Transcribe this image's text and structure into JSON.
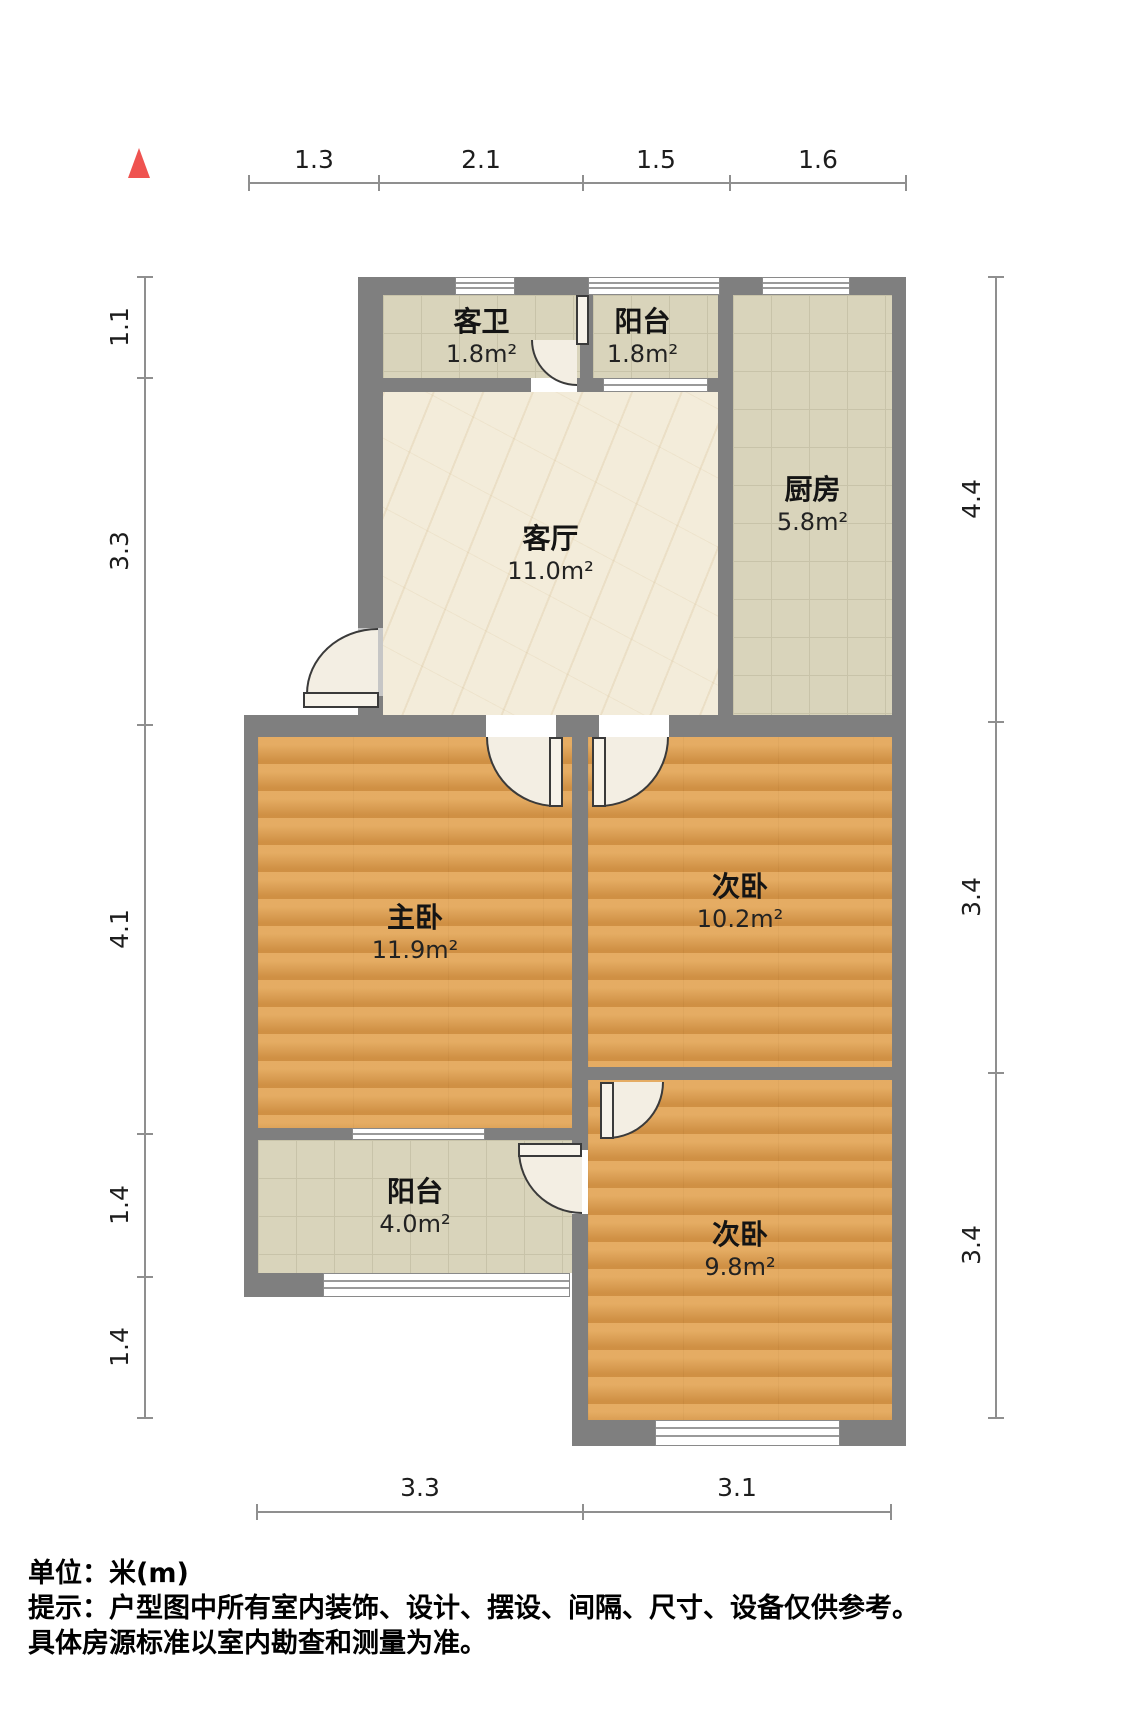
{
  "rooms": [
    {
      "name": "客卫",
      "area": "1.8m²"
    },
    {
      "name": "阳台",
      "area": "1.8m²"
    },
    {
      "name": "厨房",
      "area": "5.8m²"
    },
    {
      "name": "客厅",
      "area": "11.0m²"
    },
    {
      "name": "主卧",
      "area": "11.9m²"
    },
    {
      "name": "次卧",
      "area": "10.2m²"
    },
    {
      "name": "阳台",
      "area": "4.0m²"
    },
    {
      "name": "次卧",
      "area": "9.8m²"
    }
  ],
  "dimensions": {
    "top": [
      "1.3",
      "2.1",
      "1.5",
      "1.6"
    ],
    "left": [
      "1.1",
      "3.3",
      "4.1",
      "1.4",
      "1.4"
    ],
    "right": [
      "4.4",
      "3.4",
      "3.4"
    ],
    "bottom": [
      "3.3",
      "3.1"
    ]
  },
  "footer": {
    "line1": "单位：米(m)",
    "line2": "提示：户型图中所有室内装饰、设计、摆设、间隔、尺寸、设备仅供参考。",
    "line3": "具体房源标准以室内勘查和测量为准。"
  },
  "colors": {
    "wall": "#7f7f7f",
    "wood_floor": "#dc9c4f",
    "tile_floor": "#d9d4bb",
    "marble_floor": "#f3ecda",
    "north_arrow": "#ef5350",
    "dimension_line": "#8f8f8f"
  }
}
